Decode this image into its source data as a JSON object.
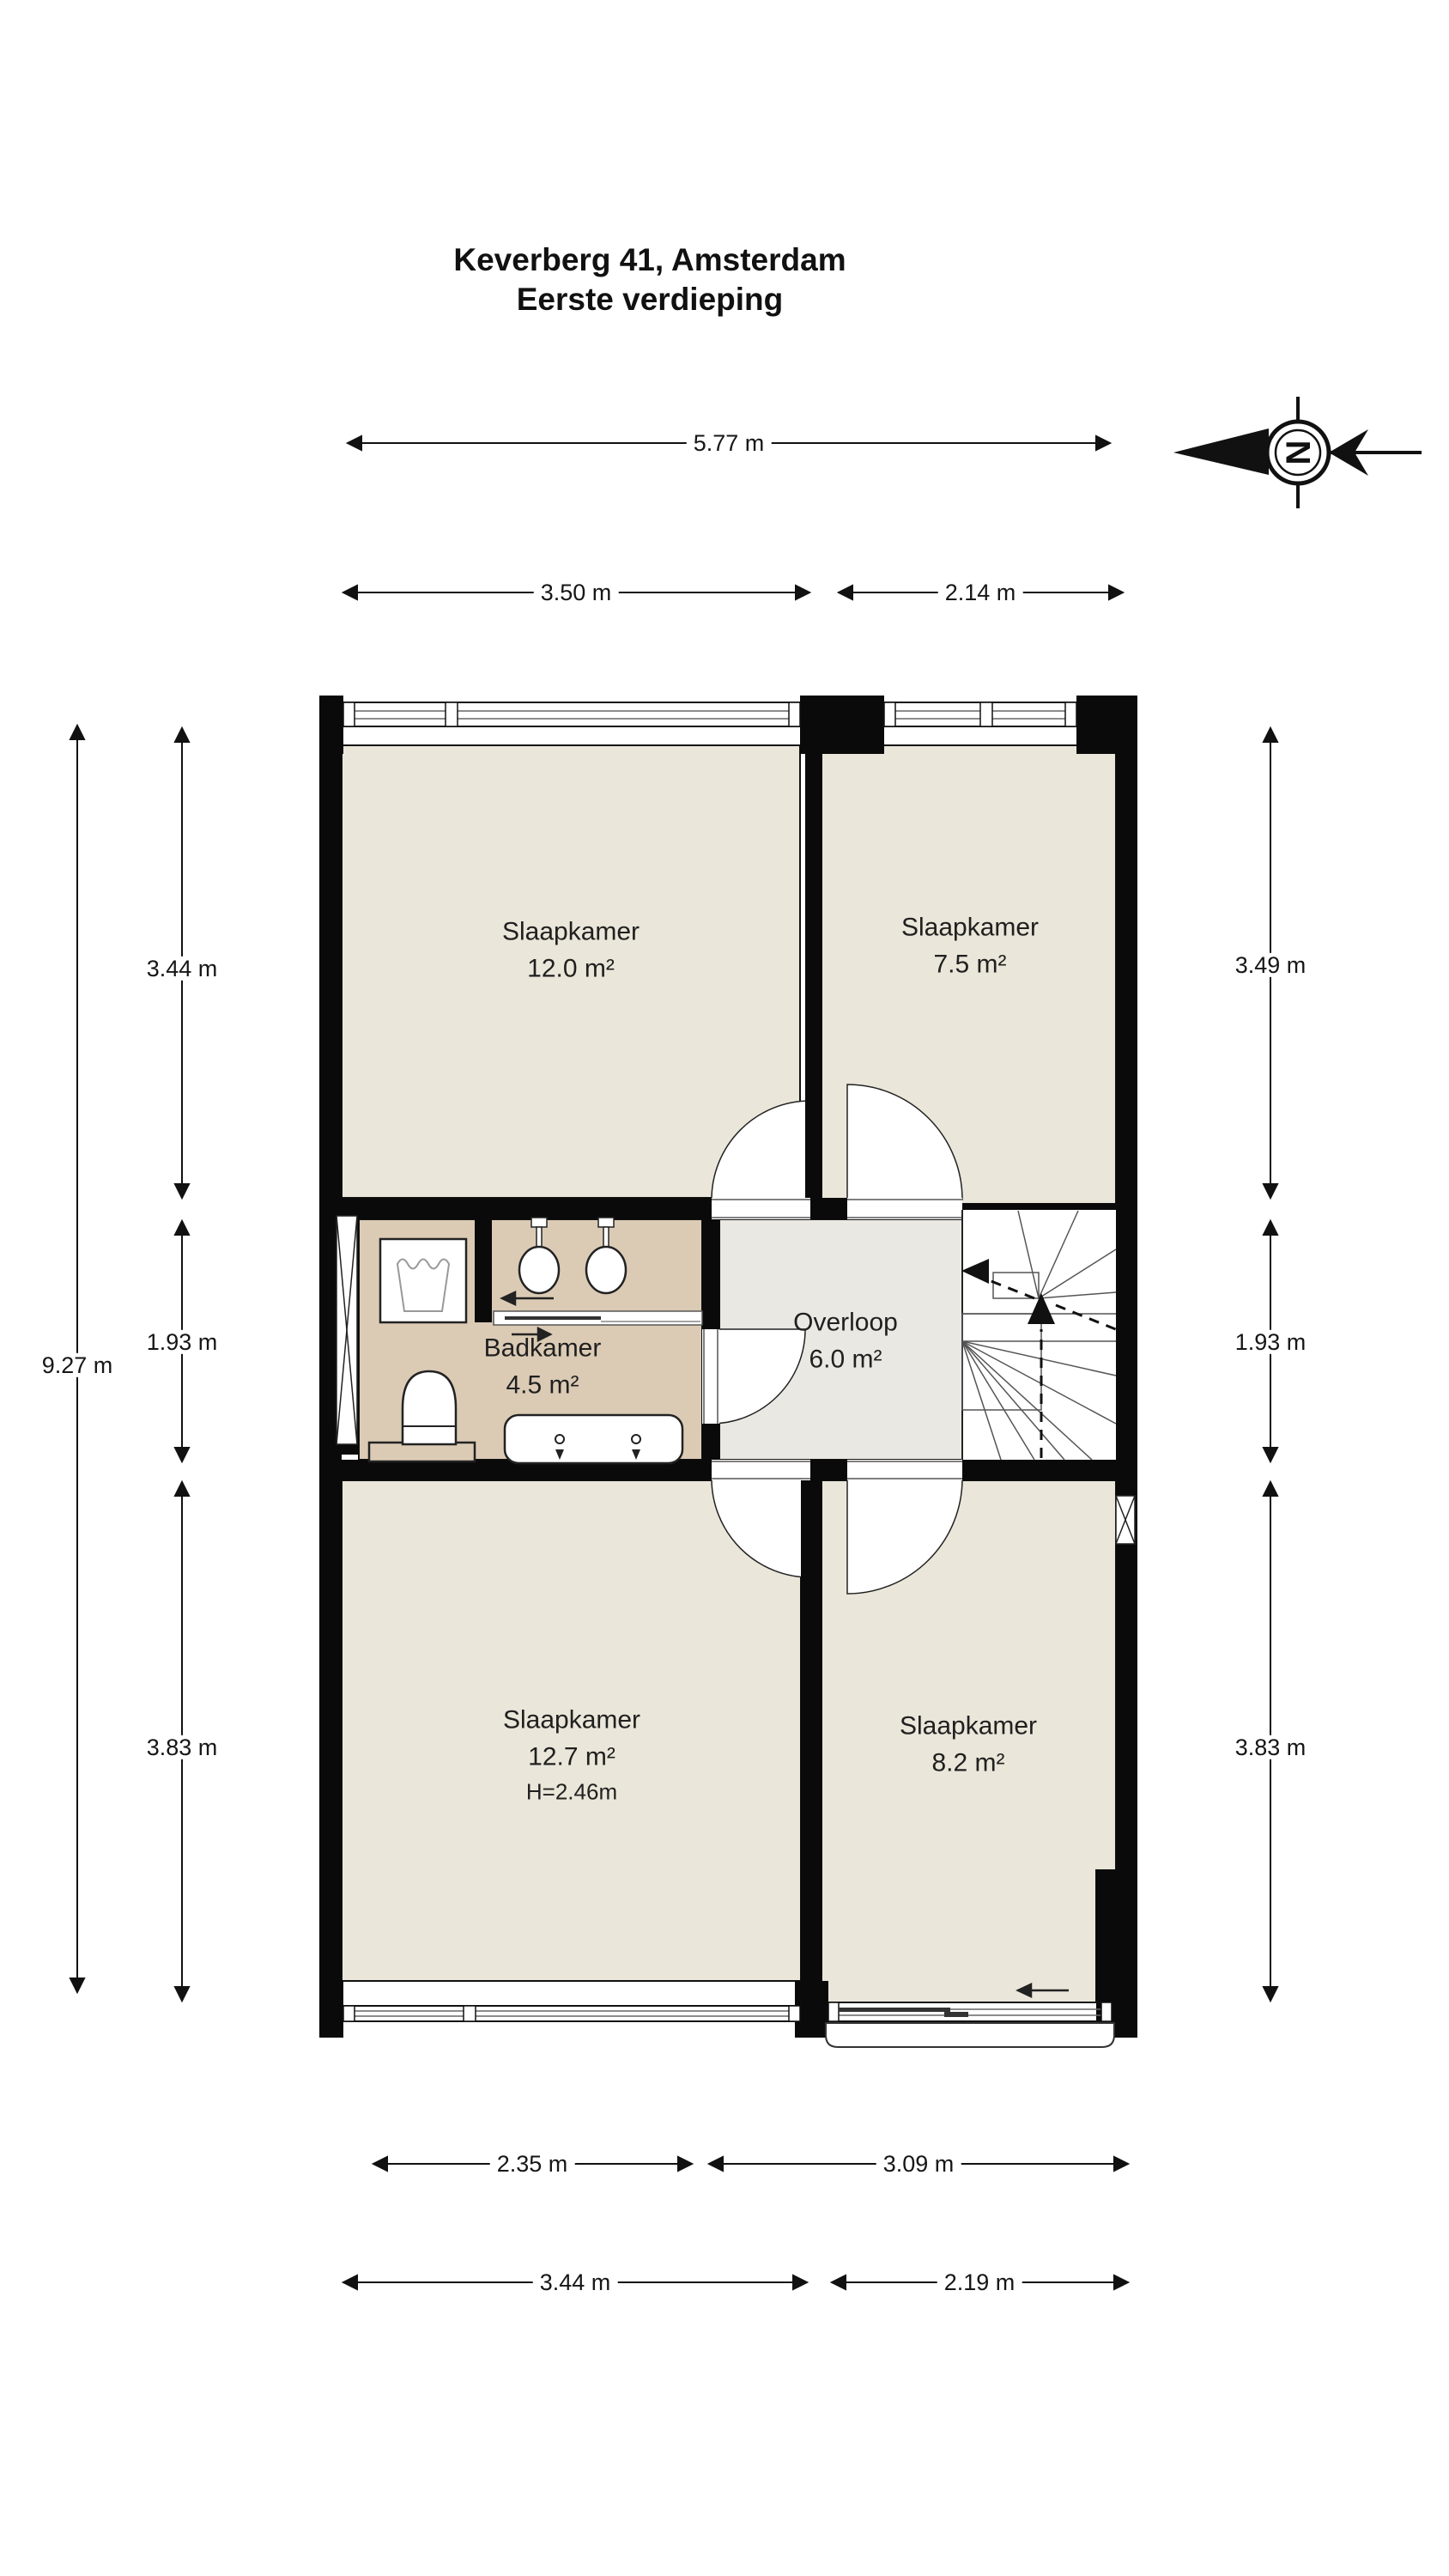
{
  "title": {
    "line1": "Keverberg 41, Amsterdam",
    "line2": "Eerste verdieping"
  },
  "compass": {
    "letter": "N"
  },
  "dims": {
    "top": {
      "total": "5.77 m",
      "left": "3.50 m",
      "right": "2.14 m"
    },
    "bottom": {
      "inner_left": "2.35 m",
      "inner_right": "3.09 m",
      "outer_left": "3.44 m",
      "outer_right": "2.19 m"
    },
    "left": {
      "total": "9.27 m",
      "top": "3.44 m",
      "middle": "1.93 m",
      "bottom": "3.83 m"
    },
    "right": {
      "top": "3.49 m",
      "middle": "1.93 m",
      "bottom": "3.83 m"
    }
  },
  "rooms": {
    "bedroom_top_left": {
      "name": "Slaapkamer",
      "area": "12.0 m²"
    },
    "bedroom_top_right": {
      "name": "Slaapkamer",
      "area": "7.5 m²"
    },
    "bathroom": {
      "name": "Badkamer",
      "area": "4.5 m²"
    },
    "landing": {
      "name": "Overloop",
      "area": "6.0 m²"
    },
    "bedroom_bottom_left": {
      "name": "Slaapkamer",
      "area": "12.7 m²",
      "height_note": "H=2.46m"
    },
    "bedroom_bottom_right": {
      "name": "Slaapkamer",
      "area": "8.2 m²"
    }
  },
  "colors": {
    "wall": "#0a0a0a",
    "bedroom_floor": "#eae6d9",
    "bathroom_floor": "#dbcbb5",
    "landing_floor": "#e9e8e2",
    "line": "#555555"
  }
}
